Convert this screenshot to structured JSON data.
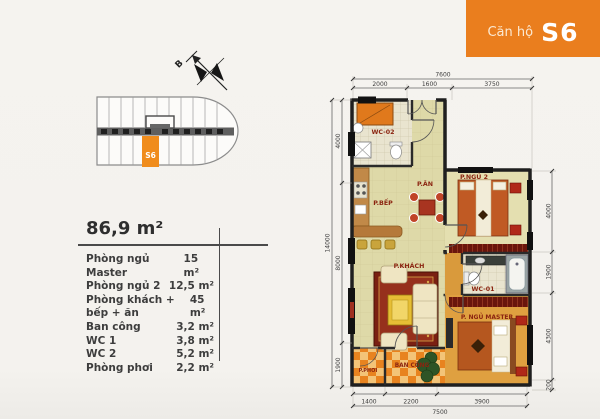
{
  "header": {
    "prefix": "Căn hộ",
    "code": "S6"
  },
  "key_plan": {
    "highlighted_unit": "S6",
    "compass_north": "B"
  },
  "area_table": {
    "total": "86,9 m²",
    "rows": [
      {
        "label": "Phòng ngủ Master",
        "value": "15 m²"
      },
      {
        "label": "Phòng ngủ 2",
        "value": "12,5 m²"
      },
      {
        "label": "Phòng khách + bếp + ăn",
        "value": "45 m²"
      },
      {
        "label": "Ban công",
        "value": "3,2 m²"
      },
      {
        "label": "WC 1",
        "value": "3,8 m²"
      },
      {
        "label": "WC 2",
        "value": "5,2 m²"
      },
      {
        "label": "Phòng phơi",
        "value": "2,2 m²"
      }
    ]
  },
  "floor_plan": {
    "rooms": {
      "wc2": "WC-02",
      "dining": "P.ĂN",
      "kitchen": "P.BẾP",
      "bedroom2": "P.NGỦ 2",
      "living": "P.KHÁCH",
      "wc1": "WC-01",
      "master": "P. NGỦ MASTER",
      "balcony": "BAN CÔNG",
      "drying": "P.PHƠI"
    },
    "dims": {
      "top_total": "7600",
      "top": [
        "2000",
        "1600",
        "3750"
      ],
      "bottom": [
        "1400",
        "2200",
        "3900"
      ],
      "bottom_total": "7500",
      "left_total": "14000",
      "left": [
        "4000",
        "8000",
        "1900"
      ],
      "right": [
        "4000",
        "1900",
        "4300",
        "200"
      ]
    }
  },
  "colors": {
    "accent_orange": "#ea7e1e",
    "unit_highlight": "#f08c1c",
    "room_label_red": "#8b2410",
    "floor_khaki": "#ded9a8",
    "wood_floor": "#dfa040"
  }
}
